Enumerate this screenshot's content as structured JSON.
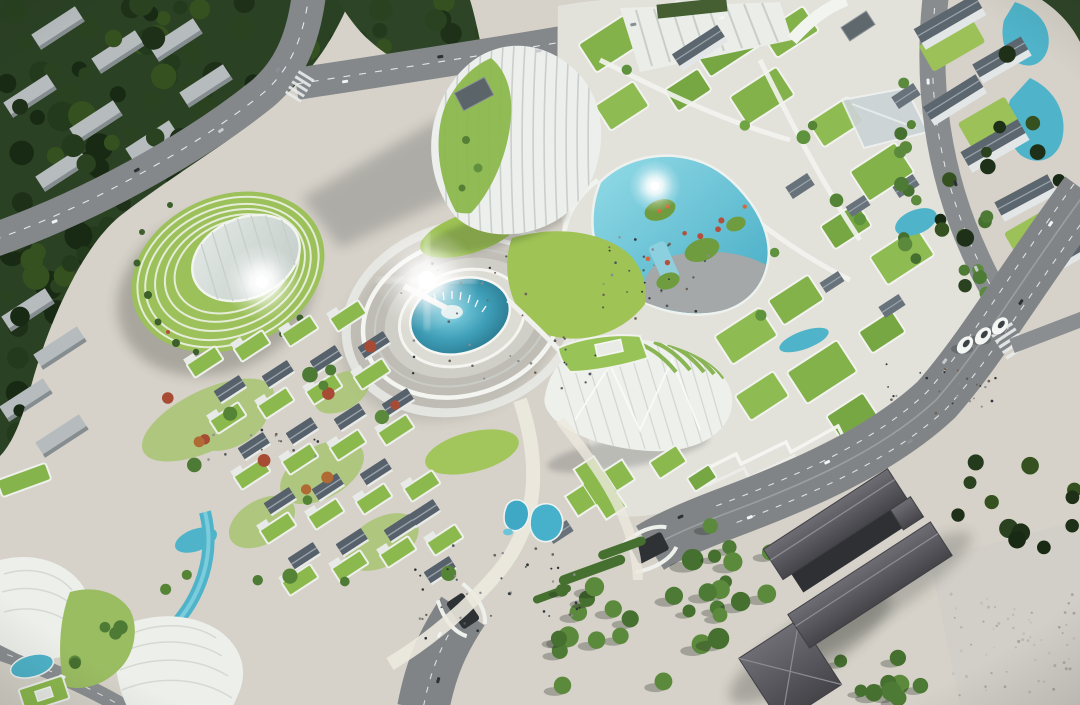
{
  "scene": {
    "title": "Aerial rendering of a futuristic eco-district masterplan",
    "description": "Bird's-eye photorealistic visualization: white organic buildings with stepped green roof terraces, a circular fountain plaza, a lagoon with planted islands, tree-lined boulevards with a road tunnel, a low-rise green-roof village, dense woodland with apartment slabs, twin reflecting pools, egg-shaped pavilions and a dark-roofed courtyard complex beside a wide arterial road.",
    "time_of_day": "daytime with sun glare lens flares",
    "palette": {
      "pavement": "#d6d2c9",
      "pavement_warm": "#ddd9d0",
      "forest": "#2b4124",
      "canopy_dark": "#1e2f18",
      "lawn": "#9fc355",
      "green_roof": "#83b14a",
      "water": "#4fb3c9",
      "water_deep": "#22667e",
      "road": "#84888b",
      "boulevard": "#808487",
      "white_building": "#eef0ed",
      "slate_roof": "#5c666e",
      "dark_roof": "#535258",
      "autumn_tree": "#c3763a",
      "red_shrub": "#b44f3c",
      "glare": "#ffffff"
    },
    "features": [
      "woodland with apartment slabs",
      "arterial road intersection",
      "terraced green-roof campus",
      "lagoon with planted islands",
      "central ring plaza with fountain pool",
      "domed garden pavilion with stepped terraces",
      "organic striped high-rise tower",
      "folded-roof exhibition hall",
      "green-roof village",
      "tree-lined boulevard with road tunnel",
      "twin teardrop reflecting pools",
      "dark-roof courtyard complex",
      "egg-shaped pavilions",
      "canal and shell-roof buildings"
    ]
  }
}
